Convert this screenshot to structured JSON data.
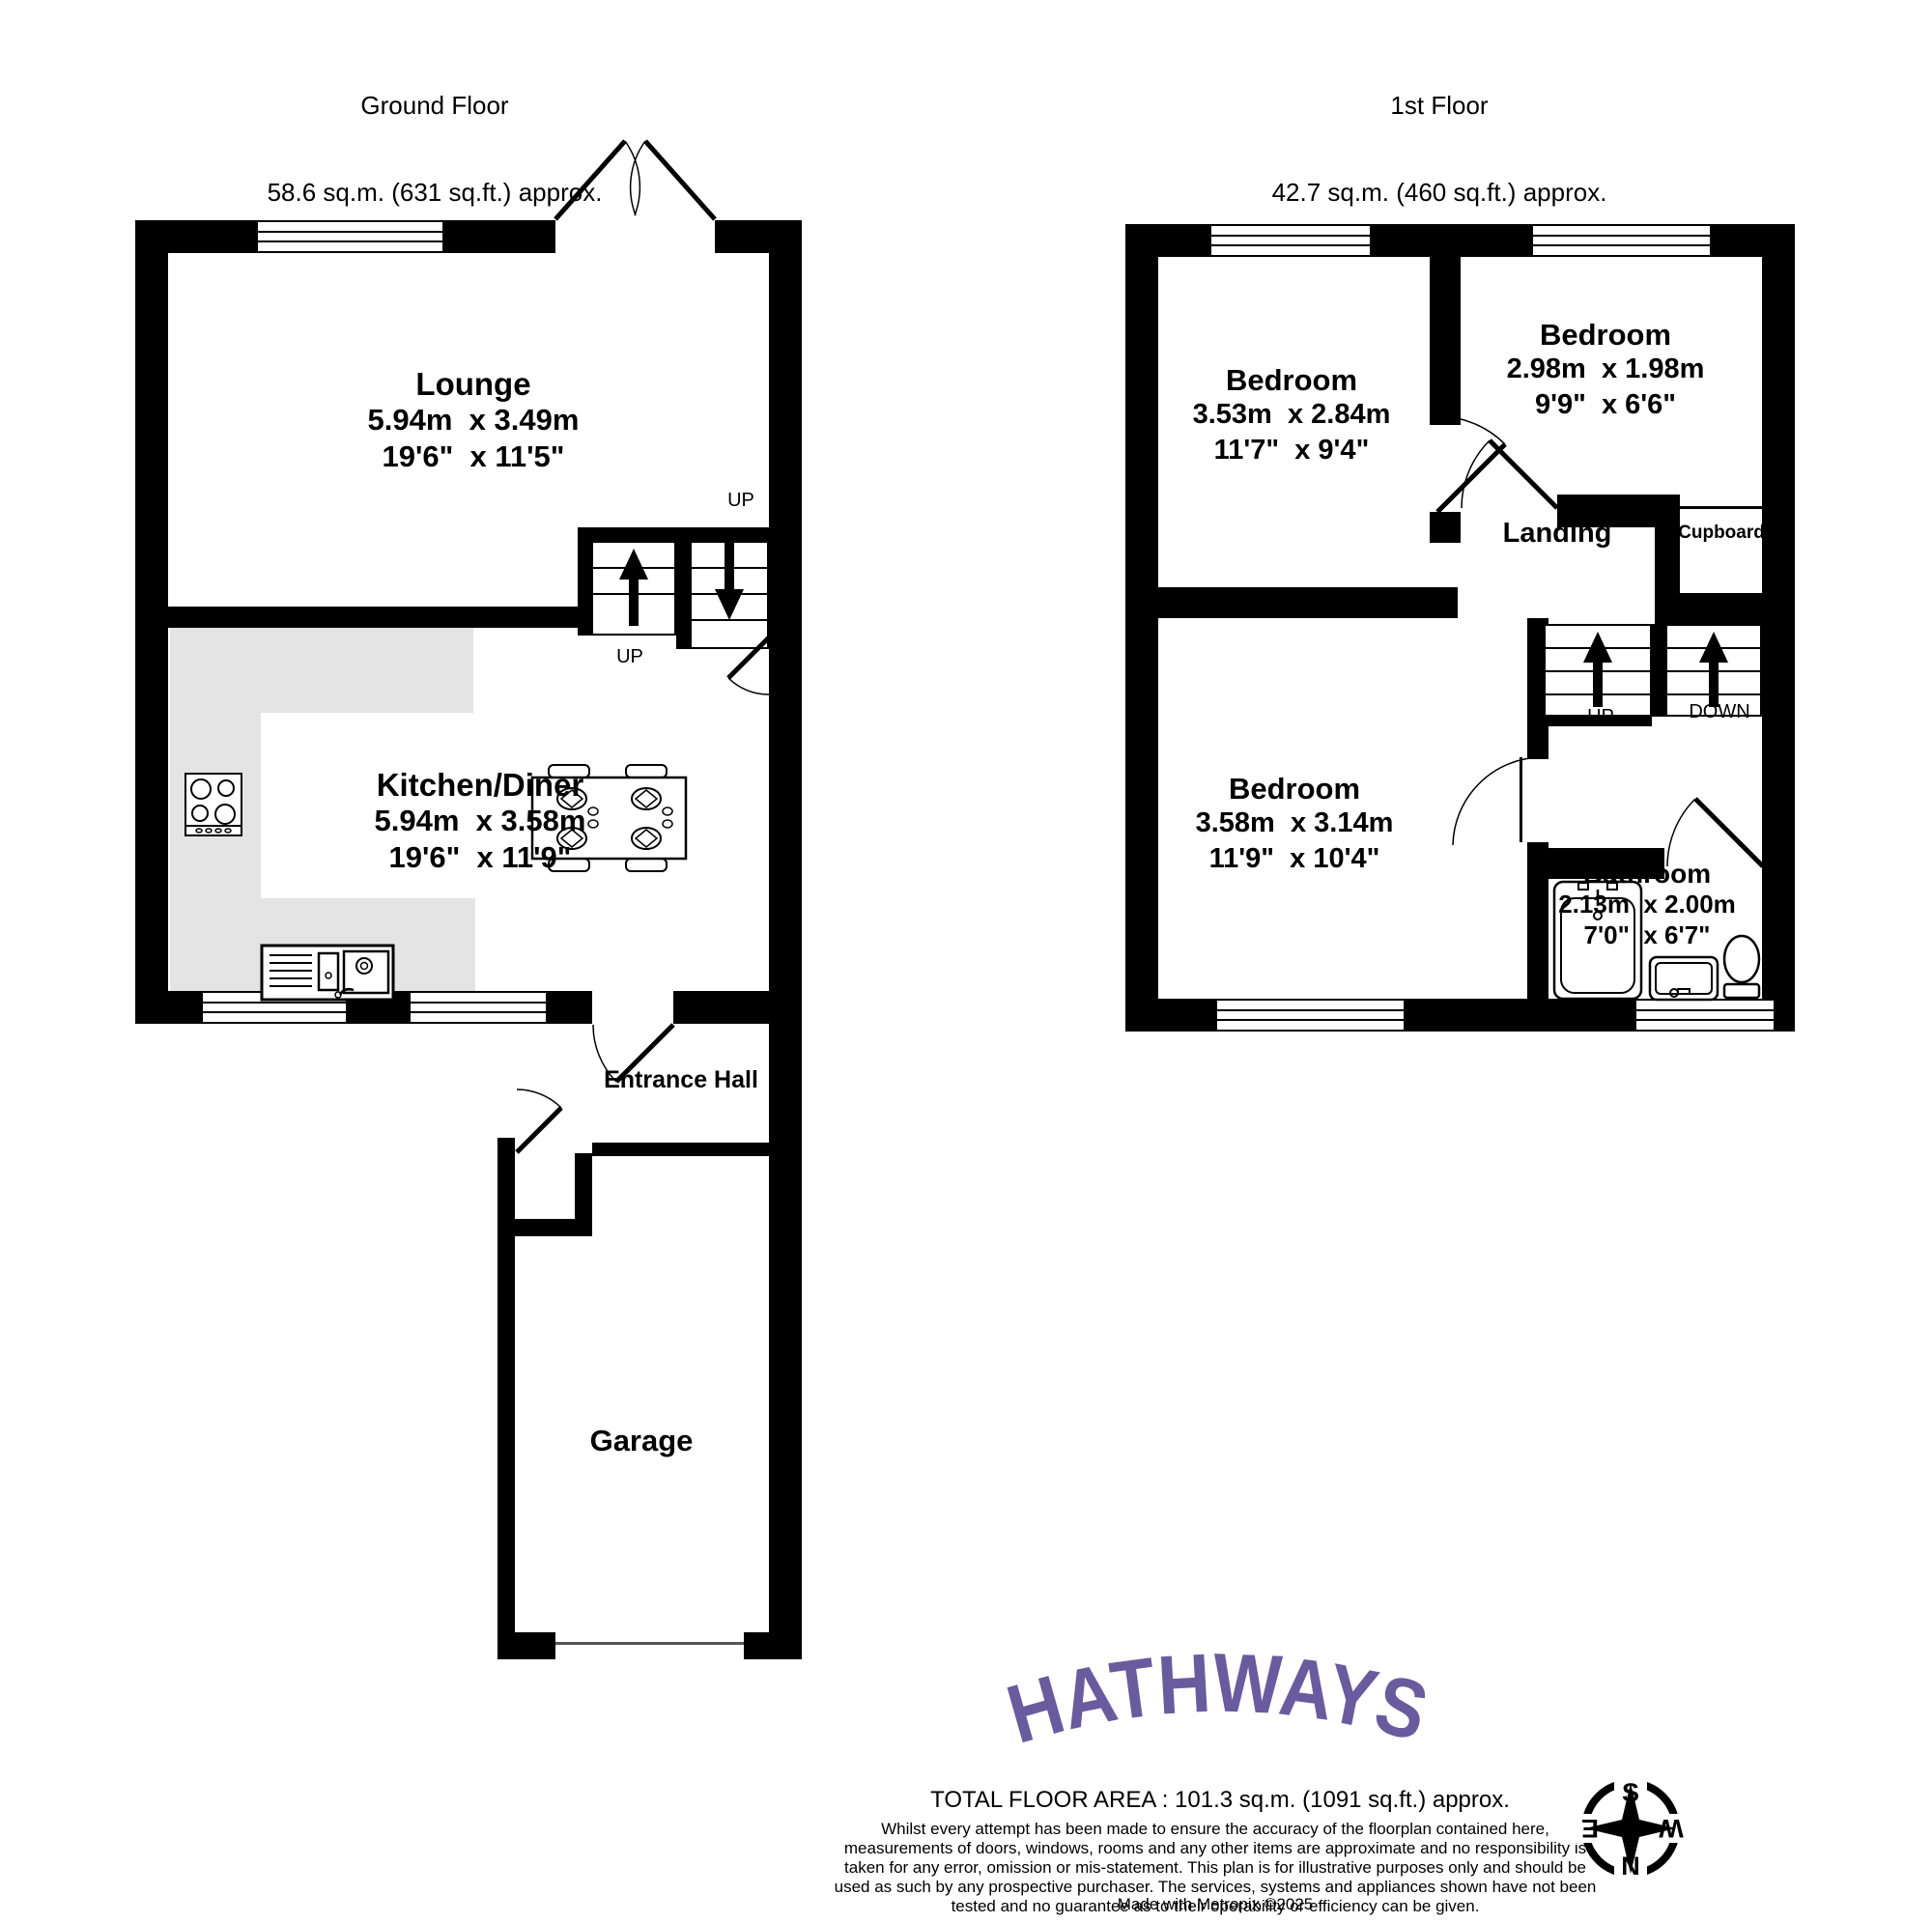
{
  "ground_floor": {
    "header": {
      "title": "Ground Floor",
      "area": "58.6 sq.m. (631 sq.ft.) approx."
    },
    "lounge": {
      "name": "Lounge",
      "metric": "5.94m  x 3.49m",
      "imperial": "19'6\"  x 11'5\""
    },
    "kitchen_diner": {
      "name": "Kitchen/Diner",
      "metric": "5.94m  x 3.58m",
      "imperial": "19'6\"  x 11'9\""
    },
    "entrance_hall": {
      "name": "Entrance Hall"
    },
    "garage": {
      "name": "Garage"
    },
    "stairs": {
      "label_top": "UP",
      "label_bottom": "UP"
    }
  },
  "first_floor": {
    "header": {
      "title": "1st Floor",
      "area": "42.7 sq.m. (460 sq.ft.) approx."
    },
    "bedroom_1": {
      "name": "Bedroom",
      "metric": "3.53m  x 2.84m",
      "imperial": "11'7\"  x 9'4\""
    },
    "bedroom_2": {
      "name": "Bedroom",
      "metric": "2.98m  x 1.98m",
      "imperial": "9'9\"  x 6'6\""
    },
    "bedroom_3": {
      "name": "Bedroom",
      "metric": "3.58m  x 3.14m",
      "imperial": "11'9\"  x 10'4\""
    },
    "bathroom": {
      "name": "Bathroom",
      "metric": "2.13m  x 2.00m",
      "imperial": "7'0\"  x 6'7\""
    },
    "landing": {
      "name": "Landing"
    },
    "cupboard": {
      "name": "Cupboard"
    },
    "stairs": {
      "label_up": "UP",
      "label_down": "DOWN"
    }
  },
  "branding": {
    "logo_text": "HATHWAYS",
    "logo_color": "#6a5b9e"
  },
  "footer": {
    "total_area": "TOTAL FLOOR AREA : 101.3 sq.m. (1091 sq.ft.) approx.",
    "disclaimer": "Whilst every attempt has been made to ensure the accuracy of the floorplan contained here, measurements of doors, windows, rooms and any other items are approximate and no responsibility is taken for any error, omission or mis-statement. This plan is for illustrative purposes only and should be used as such by any prospective purchaser. The services, systems and appliances shown have not been tested and no guarantee as to their operability or efficiency can be given.",
    "made_with": "Made with Metropix ©2025"
  },
  "compass": {
    "north": "N",
    "south": "S",
    "east": "E",
    "west": "W"
  }
}
